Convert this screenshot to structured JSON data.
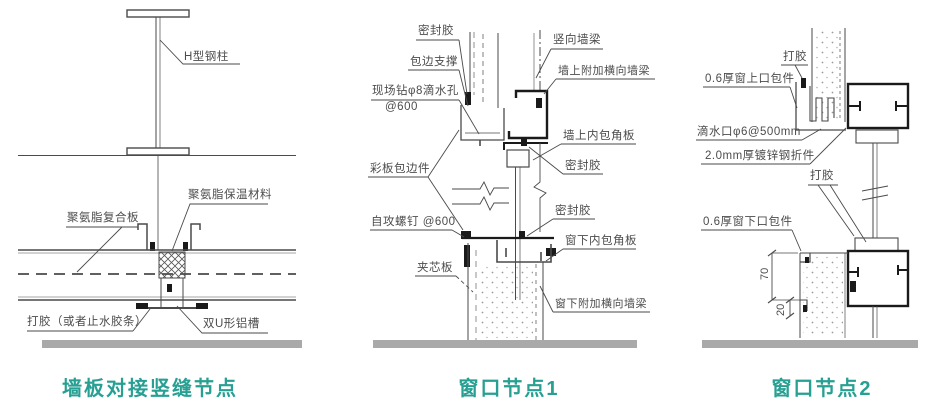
{
  "page": {
    "background": "#ffffff"
  },
  "colors": {
    "title_accent": "#27a093",
    "line": "#4a4a4a",
    "heavy_line": "#1a1a1a",
    "ground_bar": "#a9a9a9",
    "label_text": "#4c4c4c"
  },
  "panels": [
    {
      "id": "wall-joint",
      "title": "墙板对接竖缝节点",
      "labels": {
        "h_column": "H型钢柱",
        "insulation": "聚氨脂保温材料",
        "composite_panel": "聚氨脂复合板",
        "sealant": "打胶（或者止水胶条）",
        "u_channel": "双U形铝槽"
      }
    },
    {
      "id": "window-node-1",
      "title": "窗口节点1",
      "labels": {
        "sealant_top": "密封胶",
        "edge_support": "包边支撑",
        "drill_hole": "现场钻φ8滴水孔",
        "drill_spacing": "@600",
        "vertical_beam": "竖向墙梁",
        "wall_added_beam": "墙上附加横向墙梁",
        "wall_corner_panel": "墙上内包角板",
        "color_panel_edge": "彩板包边件",
        "sealant_mid": "密封胶",
        "screw": "自攻螺钉 @600",
        "sealant_lower": "密封胶",
        "window_corner_panel": "窗下内包角板",
        "sandwich_panel": "夹芯板",
        "window_added_beam": "窗下附加横向墙梁"
      }
    },
    {
      "id": "window-node-2",
      "title": "窗口节点2",
      "labels": {
        "sealant_top": "打胶",
        "top_wrap": "0.6厚窗上口包件",
        "drip": "滴水口φ6@500mm",
        "galvanized": "2.0mm厚镀锌钢折件",
        "sealant_mid": "打胶",
        "bottom_wrap": "0.6厚窗下口包件",
        "dim_70": "70",
        "dim_20": "20"
      }
    }
  ]
}
